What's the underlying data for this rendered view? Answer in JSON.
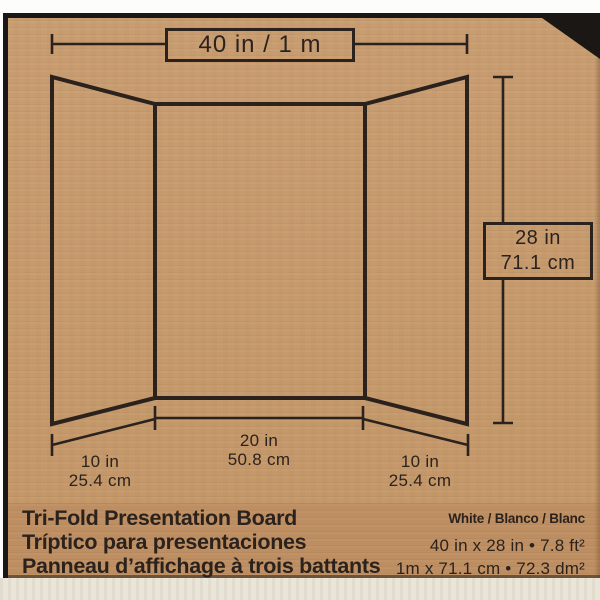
{
  "package": {
    "board_diagram": {
      "width_total": "40 in / 1 m",
      "height_in": "28 in",
      "height_cm": "71.1 cm",
      "flap_left_in": "10 in",
      "flap_left_cm": "25.4 cm",
      "center_in": "20 in",
      "center_cm": "50.8 cm",
      "flap_right_in": "10 in",
      "flap_right_cm": "25.4 cm"
    },
    "info": {
      "title_en": "Tri-Fold Presentation Board",
      "title_es": "Tríptico para presentaciones",
      "title_fr": "Panneau d’affichage à trois battants",
      "color_variants": "White / Blanco / Blanc",
      "size_imperial": "40 in x 28 in  •  7.8 ft²",
      "size_metric": "1m x 71.1 cm  •  72.3 dm²"
    },
    "colors": {
      "kraft": "#c59a6e",
      "band": "#bd8e62",
      "ink": "#2b221d",
      "frame": "#1b1715",
      "bottom_strip": "#eae5d9"
    }
  }
}
